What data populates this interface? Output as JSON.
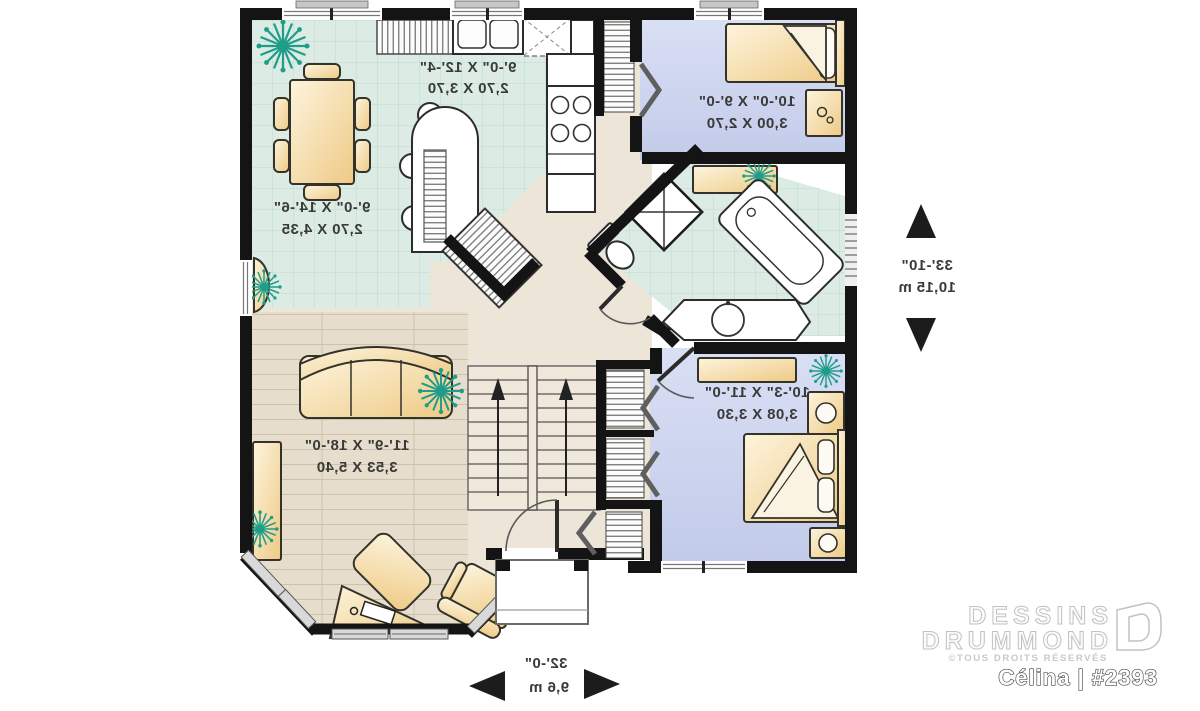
{
  "plan": {
    "type": "residential floor plan",
    "rooms": {
      "dining": {
        "imperial": "9'-0\" X 14'-6\"",
        "metric": "2,70 X 4,35"
      },
      "kitchen": {
        "imperial": "9'-0\" X 12'-4\"",
        "metric": "2,70 X 3,70"
      },
      "bedroom1": {
        "imperial": "10'-0\" X 9'-0\"",
        "metric": "3,00 X 2,70"
      },
      "bedroom2": {
        "imperial": "10'-3\" X 11'-0\"",
        "metric": "3,08 X 3,30"
      },
      "living": {
        "imperial": "11'-9\" X 18'-0\"",
        "metric": "3,53 X 5,40"
      }
    },
    "overall": {
      "depth_imperial": "33'-10\"",
      "depth_metric": "10,15 m",
      "width_imperial": "32'-0\"",
      "width_metric": "9,6 m"
    },
    "note_text_style": "dimension labels appear mirror-imaged on the plan"
  },
  "branding": {
    "name_line1": "DESSINS",
    "name_line2": "DRUMMOND",
    "rights": "©TOUS DROITS RÉSERVÉS",
    "plan_label": "Célina | #2393"
  },
  "colors": {
    "wall": "#141414",
    "tile_floor": "#dcece4",
    "tile_grid": "#bcdacd",
    "bedroom_floor": "#c9d2ec",
    "wood_floor": "#e7ddcc",
    "hall_floor": "#ece5d8",
    "furniture": "#f3d9a2",
    "furniture_light": "#fdf4dd",
    "plant": "#1f9c8a",
    "dimension_text": "#3a3a3a",
    "logo_gray": "#c6c6c6"
  }
}
